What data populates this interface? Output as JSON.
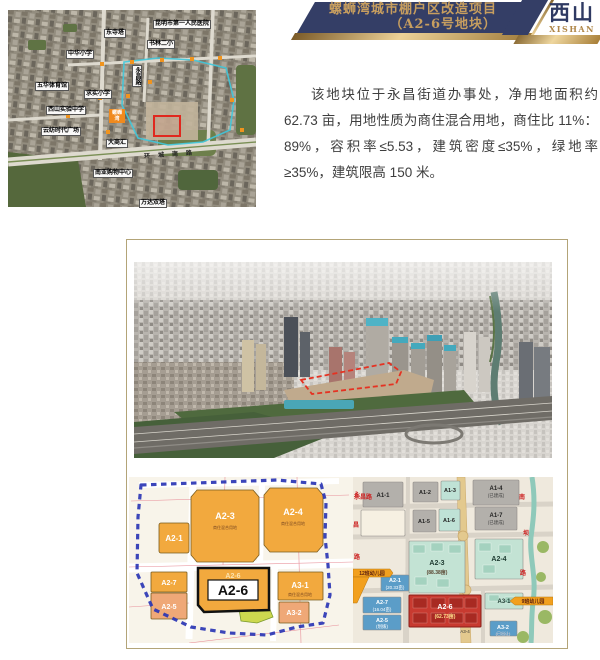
{
  "banner": {
    "title_line1": "螺蛳湾城市棚户区改造项目",
    "title_line2": "（A2-6号地块）",
    "district_cn": "西山",
    "district_en": "XISHAN"
  },
  "description": {
    "text": "该地块位于永昌街道办事处，净用地面积约 62.73 亩，用地性质为商住混合用地，商住比 11%：89%，容积率≤5.53，建筑密度≤35%，绿地率≥35%，建筑限高 150 米。"
  },
  "colors": {
    "navy": "#343e66",
    "gold": "#c79e5f",
    "frame_border": "#b3a478",
    "plot_orange": "#f2a93e",
    "plot_salmon": "#efa877",
    "plot_red": "#c83a30",
    "plot_blue": "#5b9dc8",
    "plot_teal": "#c3e3d4",
    "plot_gray": "#b3b0ab",
    "ribbon_orange": "#f2a01e",
    "boundary_blue": "#2a35b4",
    "outline_red": "#e0281e"
  },
  "satellite_map": {
    "labels": [
      "昆明市第一人民医院",
      "东寺塔",
      "书林二小",
      "中华小学",
      "五华体育馆",
      "求实小学",
      "西山实验中学",
      "云纺时代广场",
      "大商汇",
      "南亚购物中心",
      "万达双塔"
    ],
    "orange_label_line1": "螺蛳",
    "orange_label_line2": "湾",
    "vertical_label": "永昌路",
    "road_name": "环城南路"
  },
  "left_plan": {
    "plots": {
      "a2_1": {
        "label": "A2-1"
      },
      "a2_3": {
        "label": "A2-3",
        "sub": "商住混合用地"
      },
      "a2_4": {
        "label": "A2-4",
        "sub": "商住混合用地"
      },
      "a2_7": {
        "label": "A2-7"
      },
      "a2_5": {
        "label": "A2-5"
      },
      "a2_6": {
        "label": "A2-6"
      },
      "a3_1": {
        "label": "A3-1",
        "sub": "商住混合用地"
      },
      "a3_2": {
        "label": "A3-2"
      }
    },
    "highlight_label": "A2-6"
  },
  "right_plan": {
    "plots": {
      "a1_1": {
        "label": "A1-1"
      },
      "a1_2": {
        "label": "A1-2"
      },
      "a1_3": {
        "label": "A1-3"
      },
      "a1_4": {
        "label": "A1-4",
        "sub": "(已建成)"
      },
      "a1_5": {
        "label": "A1-5"
      },
      "a1_6": {
        "label": "A1-6"
      },
      "a1_7": {
        "label": "A1-7",
        "sub": "(已建成)"
      },
      "a2_3": {
        "label": "A2-3",
        "sub": "(88.38亩)"
      },
      "a2_4": {
        "label": "A2-4"
      },
      "a2_1": {
        "label": "A2-1",
        "sub": "(20.33亩)"
      },
      "a2_7": {
        "label": "A2-7",
        "sub": "(16.04亩)"
      },
      "a2_5": {
        "label": "A2-5",
        "sub": "(划拨)"
      },
      "a2_6": {
        "label": "A2-6",
        "sub": "(62.73亩)"
      },
      "a3_1": {
        "label": "A3-1"
      },
      "a3_2": {
        "label": "A3-2",
        "sub": "(已出让)"
      },
      "a3_4": {
        "label": "A3-4"
      }
    },
    "kindergarten_left": "12班幼儿园",
    "kindergarten_right": "9班幼儿园",
    "street_left": "永昌路",
    "street_right": "南坝路"
  }
}
